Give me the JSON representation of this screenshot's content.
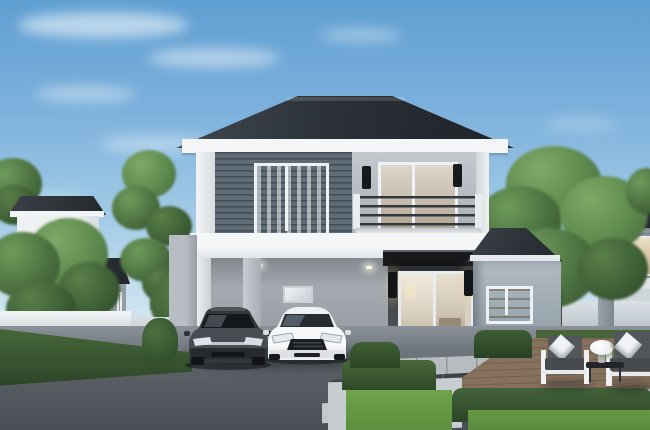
{
  "page": {
    "kind": "3D architectural exterior rendering, no visible text",
    "width": 650,
    "height": 430
  },
  "scene": {
    "title": "Two-story modern house rendering with double carport, two parked cars, landscaped yard and neighboring homes",
    "sky": {
      "label": "Clear blue sky with thin wispy clouds"
    },
    "main_house": {
      "label": "Two-story modern detached house",
      "features": [
        "dark charcoal hip roof with white fascia",
        "dark gray horizontal-siding feature wall on upper left",
        "light gray rendered walls",
        "two upper-floor sliding windows with warm interiors",
        "balcony with dark horizontal-bar railing and white parapet",
        "two black cylindrical wall sconces upstairs",
        "open double carport under cantilevered upper floor",
        "two recessed carport ceiling downlights",
        "small carport back-wall window",
        "black flat awning over entrance",
        "white-framed sliding glass entrance door with lit living room",
        "two glowing black entrance sconces",
        "single-story side wing with hip roof and lit shelf window"
      ]
    },
    "vehicles": [
      {
        "label": "Dark charcoal sedan parked in left carport bay"
      },
      {
        "label": "White sporty coupe parked in right carport bay"
      }
    ],
    "left_house": {
      "label": "Neighboring two-story house with balcony, dark fascia band and warm lit ground-floor windows"
    },
    "right_house": {
      "label": "Neighboring house behind boundary wall with lit upper window"
    },
    "landscape": {
      "trees": "Green deciduous trees: cluster at far left, slender tree left of house, large tree at right, treetops at edges",
      "hedges": "Trimmed dark-green hedges along the left boundary wall, beside the entrance and bordering the lawns",
      "lawn": "Bright green lawn panels edged with white pebble strips",
      "fence": "Low white boundary walls on both sides"
    },
    "hardscape": {
      "driveway": "Dark speckled exposed-aggregate driveway in foreground",
      "walkway": "Light concrete pavers and dark stepping slabs leading to the entrance",
      "deck": "Brown timber deck at right with plank lines"
    },
    "patio": {
      "label": "Outdoor lounge set on timber deck",
      "items": [
        "white-frame armchair with charcoal cushions and white pillow",
        "black coffee table with white flower bouquet in glass vase",
        "white-frame sofa with charcoal cushions and white pillow"
      ]
    }
  },
  "palette": {
    "sky-top": "#5f9fd1",
    "sky-horizon": "#eef4f7",
    "roof-dark": "#22272b",
    "fascia-white": "#f3f5f7",
    "siding-dark": "#5f6b75",
    "wall-light": "#b6bcc2",
    "wall-entrance": "#46494d",
    "carport-wall": "#9aa0a6",
    "window-warm": "#d9cfbd",
    "sconce-black": "#17191b",
    "railing-dark": "#33383d",
    "driveway": "#5a6066",
    "pebble-light": "#cdd2d5",
    "lawn-green": "#6aa04b",
    "hedge-green": "#3b5a31",
    "tree-green": "#5d8a4e",
    "deck-wood": "#7d6a58",
    "car-dark": "#2e3337",
    "car-white": "#f0f2f3",
    "cushion-gray": "#53575b",
    "table-black": "#22262a"
  }
}
